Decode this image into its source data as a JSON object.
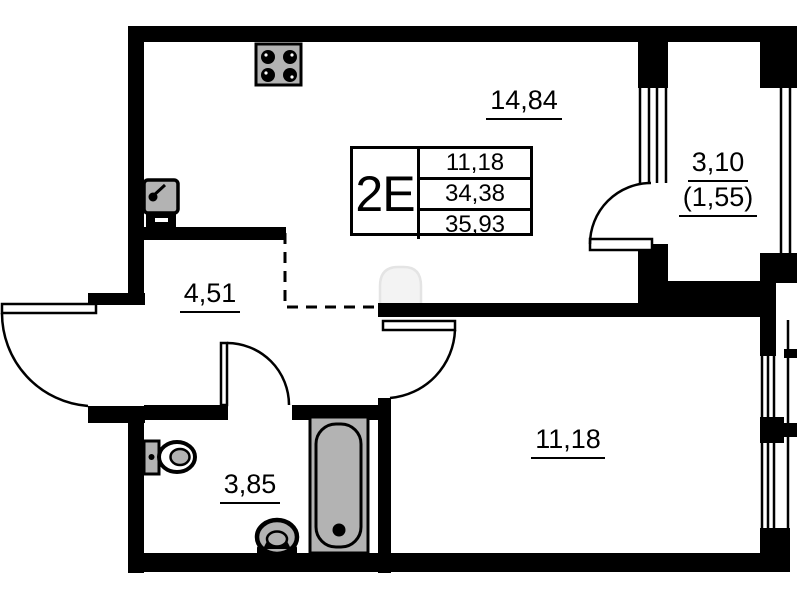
{
  "unit_card": {
    "type_label": "2E",
    "area_rows": [
      "11,18",
      "34,38",
      "35,93"
    ]
  },
  "rooms": [
    {
      "name": "kitchen-living-room",
      "area": "14,84"
    },
    {
      "name": "balcony",
      "area": "3,10",
      "area_counted": "(1,55)"
    },
    {
      "name": "hallway",
      "area": "4,51"
    },
    {
      "name": "bathroom",
      "area": "3,85"
    },
    {
      "name": "bedroom",
      "area": "11,18"
    }
  ],
  "icons": {
    "stove": "stove-icon",
    "kitchen_sink": "kitchen-sink-icon",
    "toilet": "toilet-icon",
    "washbasin": "washbasin-icon",
    "bathtub": "bathtub-icon"
  },
  "colors": {
    "walls": "#000000",
    "fixture_fill": "#b3b3b3",
    "background": "#ffffff",
    "dashed_line": "#000000"
  }
}
